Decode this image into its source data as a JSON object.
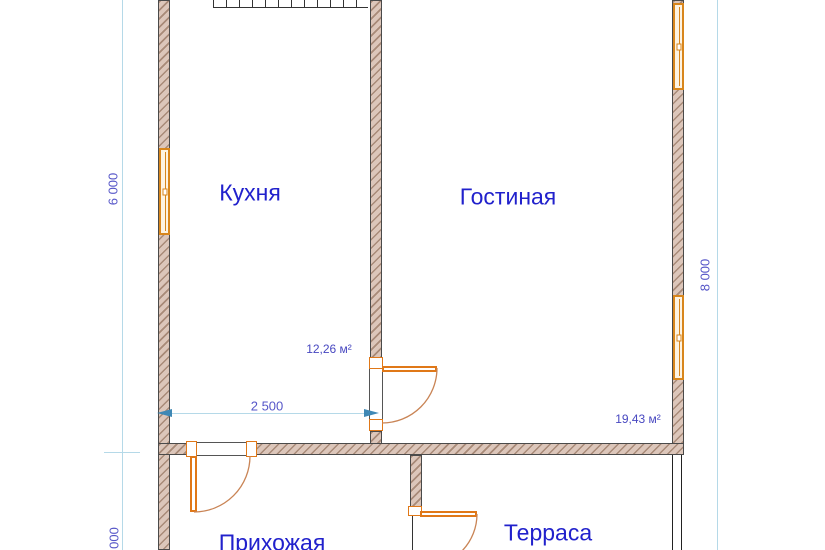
{
  "plan": {
    "rooms": [
      {
        "id": "kitchen",
        "name": "Кухня"
      },
      {
        "id": "living",
        "name": "Гостиная"
      },
      {
        "id": "hallway",
        "name": "Прихожая"
      },
      {
        "id": "terrace",
        "name": "Терраса"
      }
    ],
    "area_labels": [
      {
        "id": "kitchen-area",
        "value": "12,26 м²"
      },
      {
        "id": "living-area",
        "value": "19,43 м²"
      }
    ],
    "dimensions": [
      {
        "id": "left-vertical",
        "value": "6 000",
        "orientation": "vertical"
      },
      {
        "id": "left-vertical-bottom",
        "value": "000",
        "orientation": "vertical"
      },
      {
        "id": "right-vertical",
        "value": "8 000",
        "orientation": "vertical"
      },
      {
        "id": "kitchen-width",
        "value": "2 500",
        "orientation": "horizontal"
      }
    ],
    "features": [
      "exterior-walls-hatched",
      "three-windows",
      "three-doors-with-swing-arcs",
      "stairs-top-edge"
    ],
    "colors": {
      "wall_fill": "#dcc6ba",
      "wall_hatch": "#a88a78",
      "wall_outline": "#4a4a4a",
      "window_frame": "#d8861c",
      "window_fill": "#fdf3e2",
      "door_color": "#e07818",
      "door_arc": "#c98455",
      "dim_line": "#b5d9e8",
      "dim_arrow": "#3f88b5",
      "dim_text": "#5656c8",
      "room_text": "#2121cc",
      "area_text": "#4747c0"
    }
  }
}
